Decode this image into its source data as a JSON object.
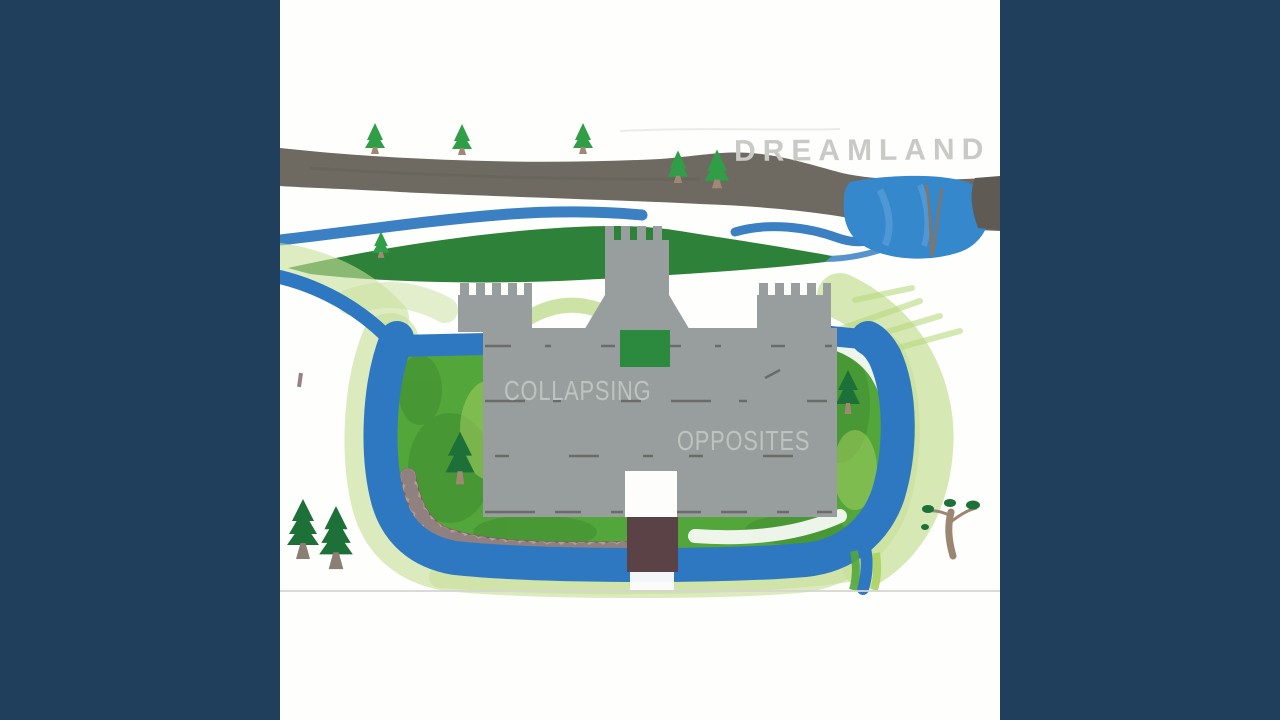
{
  "frame": {
    "kind": "album-cover-video-frame",
    "letterbox_color": "#1f3f5c",
    "paper_color": "#fefefd"
  },
  "cover": {
    "map_title": "DREAMLAND",
    "band_name_line1": "COLLAPSING",
    "band_name_line2": "OPPOSITES"
  },
  "colors": {
    "backdrop": "#1f3f5c",
    "paper": "#fefefd",
    "road": "#6e6a62",
    "road_dark": "#5f5b54",
    "hill": "#2e8138",
    "river": "#3a80c3",
    "lake": "#3488cb",
    "lake_highlight": "#5aa0d8",
    "moat": "#2e78c2",
    "grass_mid": "#53a63a",
    "grass_dark": "#3f8c32",
    "grass_light": "#abd163",
    "wash": "#c8e09b",
    "castle": "#989e9d",
    "castle_scratch": "#44443f",
    "castle_text": "#bdc4c0",
    "map_title_text": "#c9c9c6",
    "window": "#2c8a3e",
    "gate": "#fdfdfb",
    "drawbridge": "#5a4247",
    "cobblestone_path": "#7c605b",
    "tree_foliage": "#2f9e46",
    "tree_dark_foliage": "#1d7038",
    "tree_trunk": "#a08973",
    "sparse_tree_trunk": "#9b8672",
    "paper_edge_line": "#d5d5d0"
  }
}
